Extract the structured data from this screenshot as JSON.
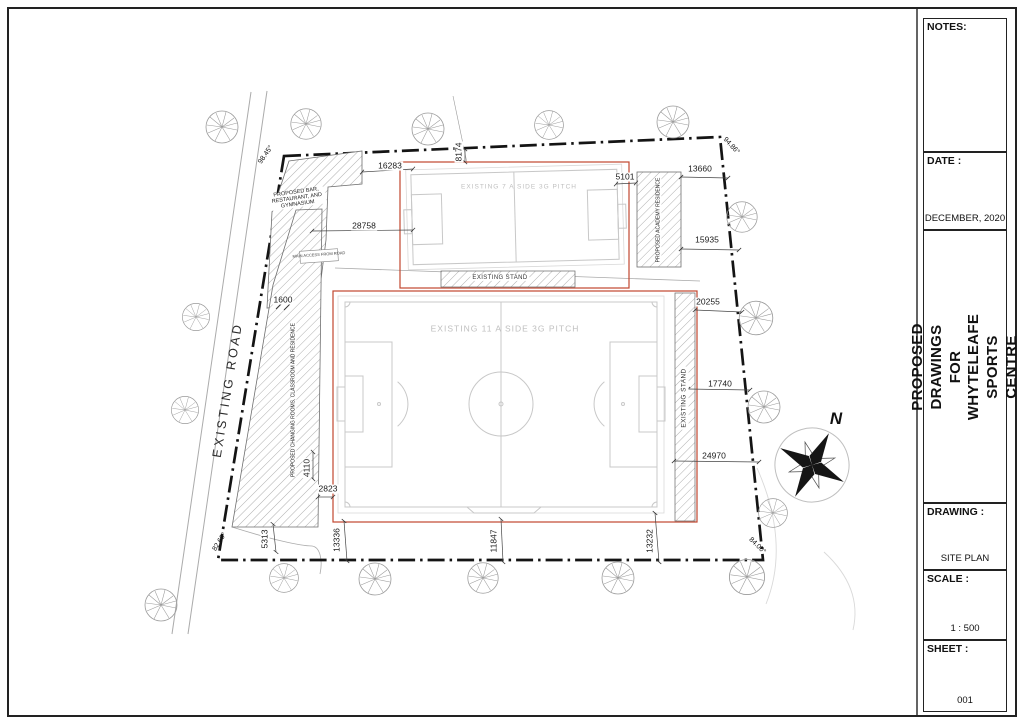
{
  "title_block": {
    "notes_label": "NOTES:",
    "date_label": "DATE :",
    "date_value": "DECEMBER, 2020",
    "project_title_line1": "PROPOSED DRAWINGS FOR",
    "project_title_line2": "WHYTELEAFE SPORTS CENTRE",
    "drawing_label": "DRAWING :",
    "drawing_value": "SITE PLAN",
    "scale_label": "SCALE :",
    "scale_value": "1 : 500",
    "sheet_label": "SHEET :",
    "sheet_value": "001"
  },
  "plan": {
    "road_label": "EXISTING ROAD",
    "north_label": "N",
    "pitch7_label": "EXISTING 7 A SIDE 3G PITCH",
    "pitch11_label": "EXISTING 11 A SIDE 3G PITCH",
    "stand_bottom_label": "EXISTING STAND",
    "stand_right_label": "EXISTING STAND",
    "building_bar_label": "PROPOSED BAR, RESTAURANT, AND GYMNASIUM",
    "building_academy_label": "PROPOSED ACADEMY RESIDENCE",
    "building_changing_label": "PROPOSED CHANGING ROOMS, CLASSROOM AND RESIDENCE",
    "access_label": "MAIN ACCESS FROM ROAD",
    "angles": {
      "top_left": "98.45°",
      "top_right": "94.86°",
      "bottom_left": "82.69°",
      "bottom_right": "84.00°"
    },
    "dimensions": {
      "d16283": "16283",
      "d28758": "28758",
      "d8174": "8174",
      "d5101": "5101",
      "d13660": "13660",
      "d15935": "15935",
      "d20255": "20255",
      "d17740": "17740",
      "d24970": "24970",
      "d1600": "1600",
      "d4110": "4110",
      "d2823": "2823",
      "d5313": "5313",
      "d13336": "13336",
      "d11847": "11847",
      "d13232": "13232"
    },
    "colors": {
      "pitch_enclosure_red": "#c2462e",
      "pitch_line_gray": "#c8c8c8",
      "boundary_black": "#141414"
    }
  }
}
